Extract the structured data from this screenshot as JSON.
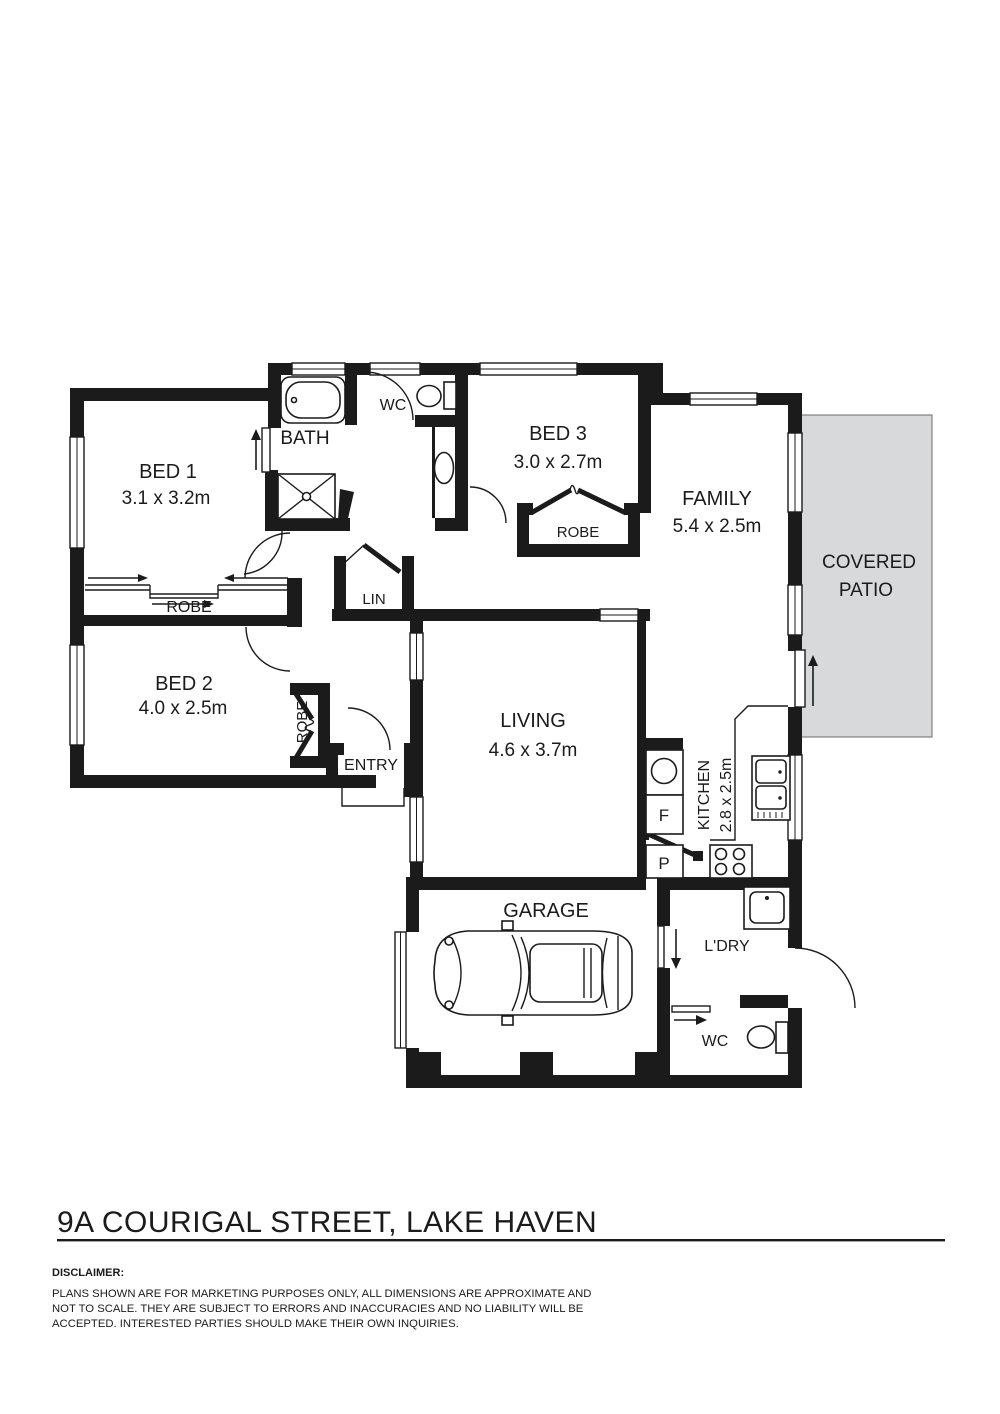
{
  "title": "9A COURIGAL STREET, LAKE HAVEN",
  "disclaimer": {
    "heading": "DISCLAIMER:",
    "lines": [
      "PLANS SHOWN ARE FOR MARKETING PURPOSES ONLY, ALL DIMENSIONS ARE APPROXIMATE AND",
      "NOT TO SCALE. THEY ARE SUBJECT TO ERRORS AND INACCURACIES AND NO LIABILITY WILL BE",
      "ACCEPTED. INTERESTED PARTIES SHOULD MAKE THEIR OWN INQUIRIES."
    ]
  },
  "plan": {
    "colors": {
      "wall": "#1b1b1b",
      "patio_fill": "#d8d9da"
    },
    "rooms": {
      "bed1": {
        "name": "BED 1",
        "dims": "3.1 x 3.2m"
      },
      "bed2": {
        "name": "BED 2",
        "dims": "4.0 x 2.5m"
      },
      "bed3": {
        "name": "BED 3",
        "dims": "3.0 x 2.7m"
      },
      "bath": {
        "name": "BATH"
      },
      "wc_top": {
        "name": "WC"
      },
      "family": {
        "name": "FAMILY",
        "dims": "5.4 x 2.5m"
      },
      "living": {
        "name": "LIVING",
        "dims": "4.6 x 3.7m"
      },
      "kitchen": {
        "name": "KITCHEN",
        "dims": "2.8 x 2.5m"
      },
      "garage": {
        "name": "GARAGE"
      },
      "laundry": {
        "name": "L'DRY"
      },
      "wc_bottom": {
        "name": "WC"
      },
      "entry": {
        "name": "ENTRY"
      },
      "linen": {
        "name": "LIN"
      },
      "patio": {
        "line1": "COVERED",
        "line2": "PATIO"
      },
      "robe_bed1": {
        "name": "ROBE"
      },
      "robe_bed2": {
        "name": "ROBE"
      },
      "robe_bed3": {
        "name": "ROBE"
      }
    },
    "fixtures": {
      "fridge_label": "F",
      "pantry_label": "P"
    }
  }
}
